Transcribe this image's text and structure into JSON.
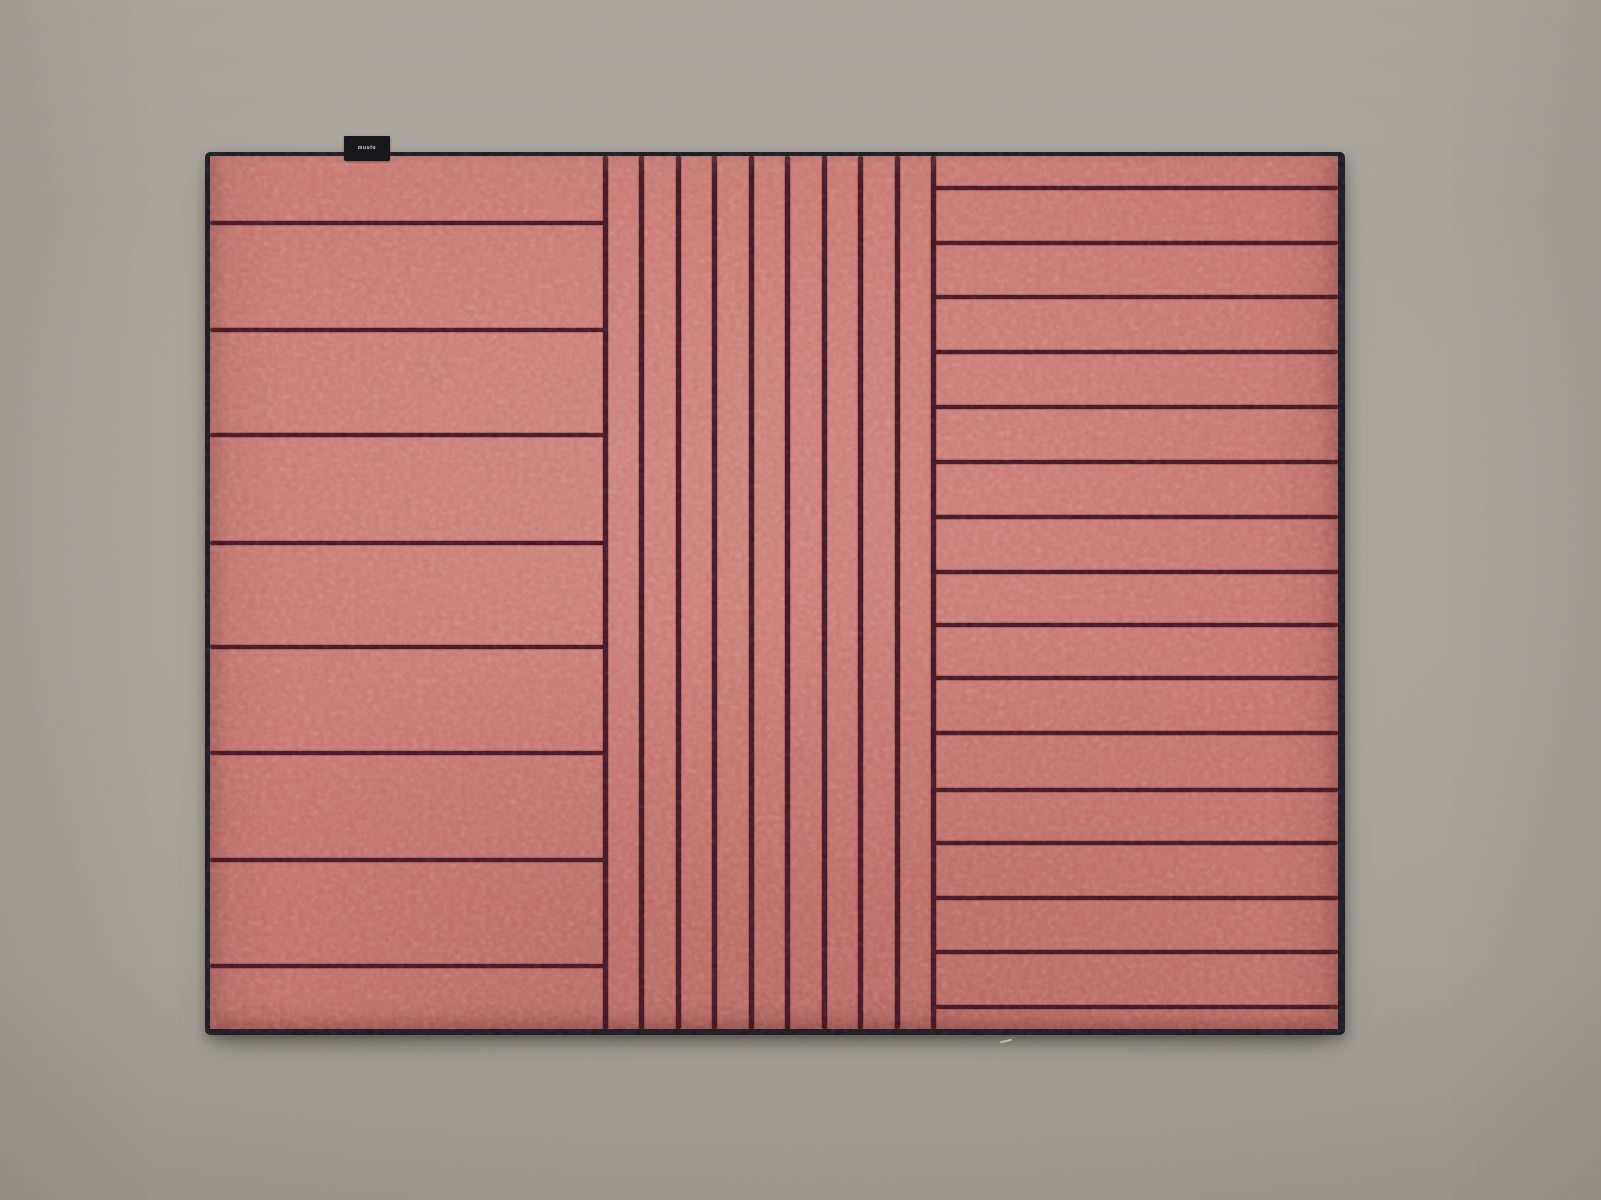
{
  "scene": {
    "description": "Top-down product photograph of a rectangular coral-red wool rug with a dark burgundy line pattern, lying on a warm grey floor",
    "floor_color": "#a7a29a",
    "vignette_color": "#918c83"
  },
  "rug": {
    "base_color": "#c5716b",
    "stripe_color": "#421620",
    "binding_color": "#1a191e",
    "position": {
      "left": 205,
      "top": 152,
      "width": 1140,
      "height": 883
    },
    "border_px": {
      "top": 4,
      "right": 7,
      "bottom": 6,
      "left": 5
    },
    "pattern_description": "Left panel: wide horizontal bands. Center panel: narrow vertical pinstripes. Right panel: narrow horizontal bands.",
    "sections": [
      {
        "name": "left-panel",
        "orientation": "horizontal",
        "line_count": 8,
        "band_count": 9,
        "line_offsets_px": [
          67,
          174,
          279,
          387,
          491,
          597,
          704,
          810
        ],
        "span_px": [
          0,
          397
        ]
      },
      {
        "name": "center-panel",
        "orientation": "vertical",
        "line_count": 10,
        "band_count": 9,
        "line_offsets_px": [
          395,
          431,
          468,
          504,
          541,
          577,
          614,
          650,
          687,
          723
        ],
        "span_px": [
          0,
          873
        ]
      },
      {
        "name": "right-panel",
        "orientation": "horizontal",
        "line_count": 16,
        "band_count": 17,
        "line_offsets_px": [
          32,
          87,
          141,
          196,
          251,
          306,
          361,
          416,
          469,
          522,
          577,
          634,
          687,
          742,
          796,
          851
        ],
        "span_px": [
          723,
          1128
        ]
      }
    ],
    "label_tag": {
      "text": "muuto",
      "background": "#17161a",
      "text_color": "#d9d6d0",
      "left": 344,
      "top": 136,
      "width": 46,
      "height": 25
    },
    "dust_speck": {
      "left": 1000,
      "top": 1040
    }
  }
}
